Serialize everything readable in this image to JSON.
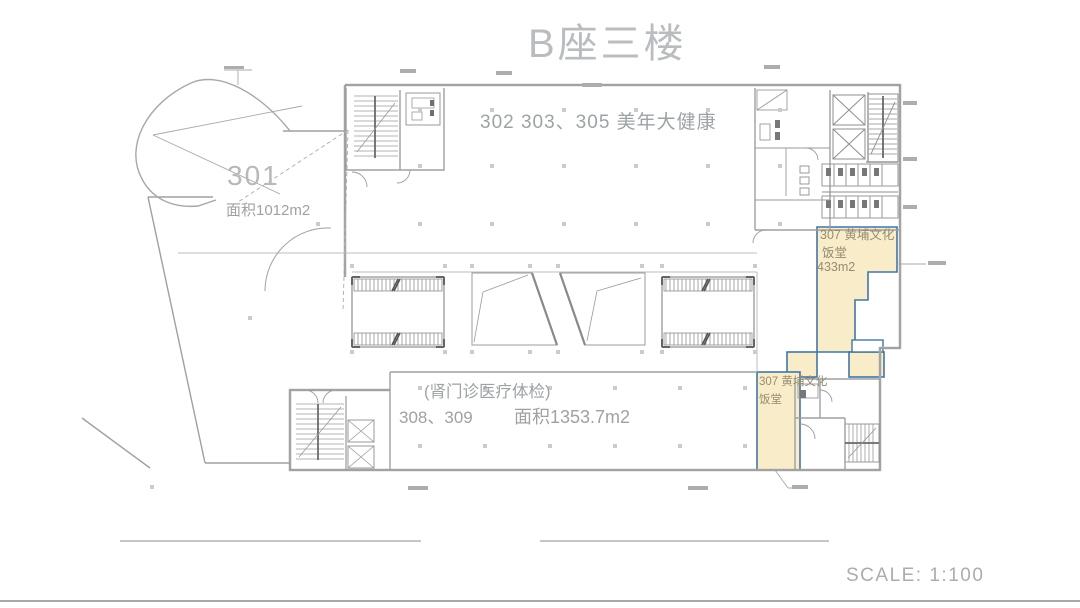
{
  "title": "B座三楼",
  "footer": {
    "scale": "SCALE: 1:100"
  },
  "rooms": {
    "hall_upper": {
      "label": "302  303、305  美年大健康"
    },
    "r301": {
      "number": "301",
      "area": "面积1012m2"
    },
    "hall_lower": {
      "note": "(肾门诊医疗体检)",
      "numbers": "308、309",
      "area": "面积1353.7m2"
    },
    "r307_upper": {
      "line1": "307 黄埔文化",
      "line2": "饭堂",
      "line3": "433m2"
    },
    "r307_lower": {
      "line1": "307 黄埔文化",
      "line2": "饭堂"
    }
  },
  "colors": {
    "highlight_fill": "#f9edc9",
    "highlight_border": "#4077a8",
    "line_gray": "#a5a5a5",
    "label_gray": "#9aa0a3"
  }
}
